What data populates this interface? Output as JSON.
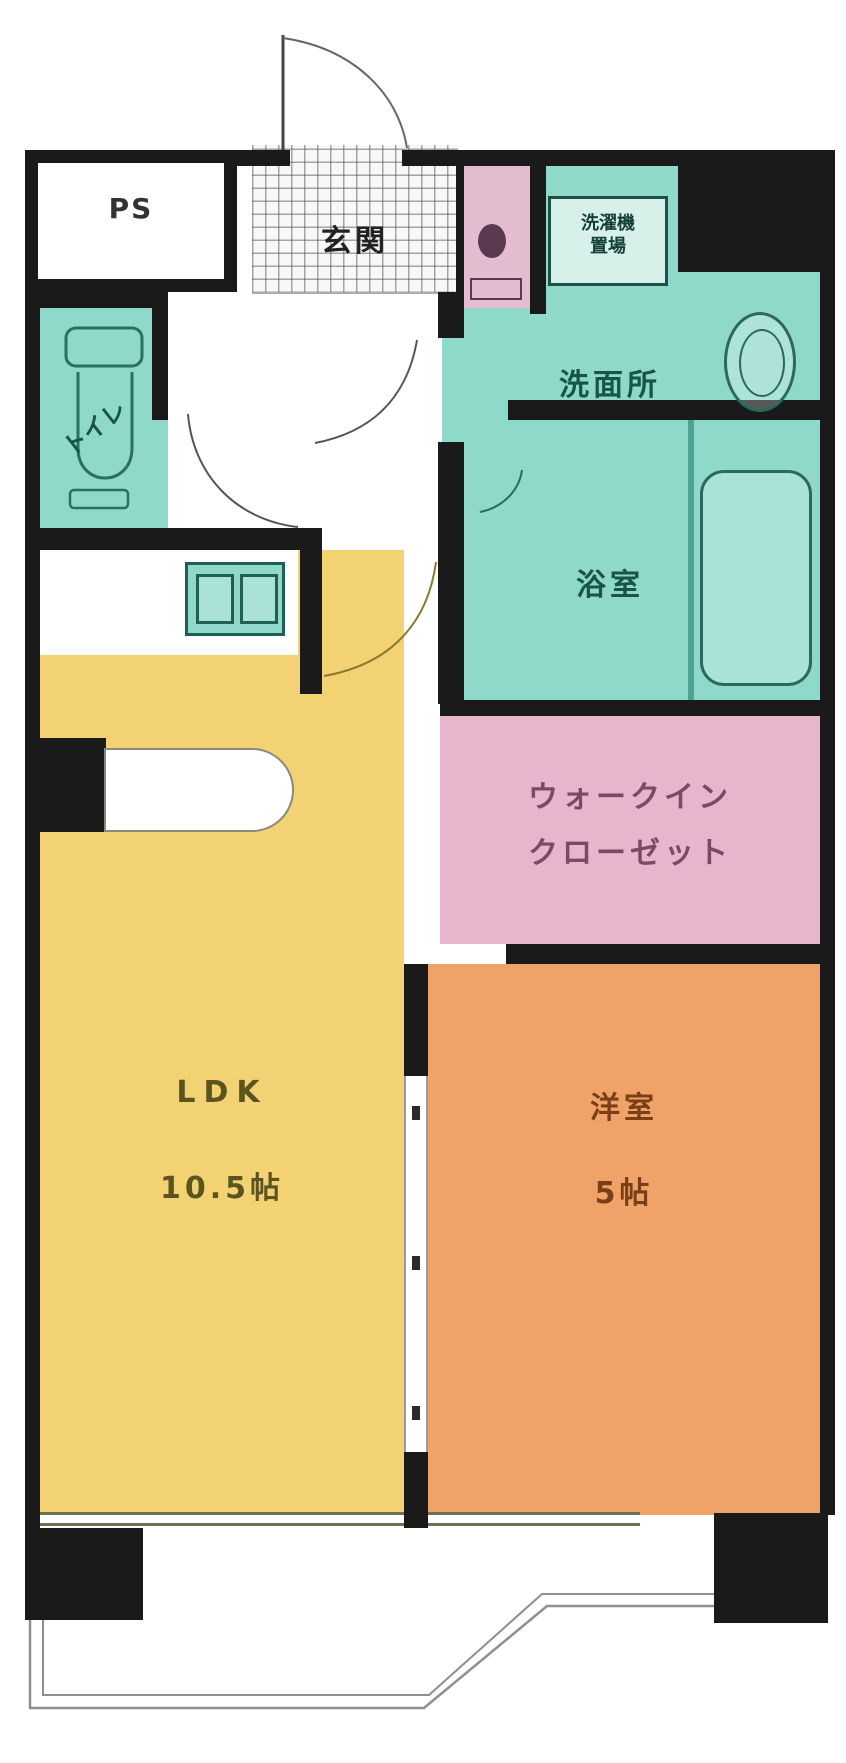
{
  "floorplan": {
    "rooms": {
      "ps": {
        "label": "PS"
      },
      "genkan": {
        "label": "玄関"
      },
      "washroom": {
        "label": "洗面所",
        "laundry_line1": "洗濯機",
        "laundry_line2": "置場"
      },
      "bathroom": {
        "label": "浴室"
      },
      "toilet": {
        "label": "トイレ"
      },
      "closet": {
        "label_line1": "ウォークイン",
        "label_line2": "クローゼット"
      },
      "ldk": {
        "label": "LDK",
        "size": "10.5帖"
      },
      "bedroom": {
        "label": "洋室",
        "size": "5帖"
      }
    },
    "colors": {
      "wall": "#1a1a1a",
      "ldk": "#f2d272",
      "bedroom": "#f0a368",
      "wet_area": "#8fd9cb",
      "bathtub": "#a8e2d8",
      "closet": "#e7b6cc",
      "entry_strip": "#e3bcd0",
      "fixture_outline": "#2a6a5e"
    }
  }
}
